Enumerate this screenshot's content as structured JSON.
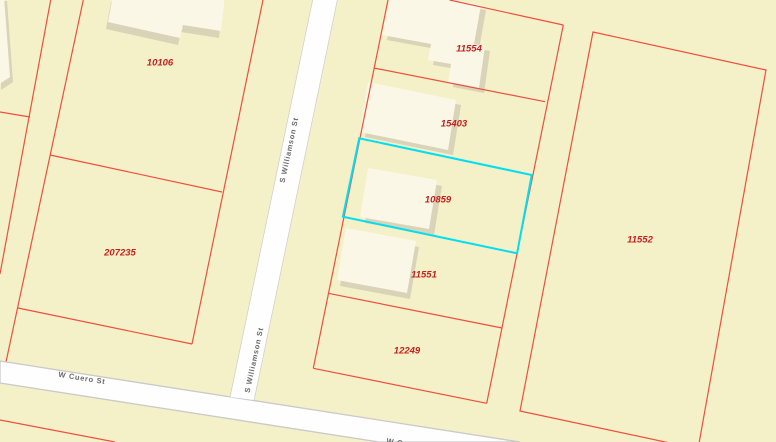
{
  "map": {
    "title": "parcel-map-view",
    "selected_parcel": "10859",
    "colors": {
      "background": "#f4f0c8",
      "parcel_line": "#ef4f3e",
      "parcel_label": "#c51f1c",
      "highlight": "#00dff2",
      "street_fill": "#fefefe",
      "street_casing": "#c9c9c9",
      "street_label": "#6a6a6a",
      "building_fill": "#faf7e7",
      "building_shadow": "#d9d3b8"
    },
    "parcels": [
      {
        "label": "10106",
        "label_x": 160,
        "label_y": 63,
        "selected": false
      },
      {
        "label": "207235",
        "label_x": 120,
        "label_y": 253,
        "selected": false
      },
      {
        "label": "11554",
        "label_x": 469,
        "label_y": 49,
        "selected": false
      },
      {
        "label": "15403",
        "label_x": 454,
        "label_y": 124,
        "selected": false
      },
      {
        "label": "10859",
        "label_x": 438,
        "label_y": 200,
        "selected": true
      },
      {
        "label": "11551",
        "label_x": 424,
        "label_y": 275,
        "selected": false
      },
      {
        "label": "12249",
        "label_x": 407,
        "label_y": 351,
        "selected": false
      },
      {
        "label": "11552",
        "label_x": 640,
        "label_y": 240,
        "selected": false
      }
    ],
    "streets": [
      {
        "name": "S Williamson St",
        "labels": [
          {
            "x": 289,
            "y": 150,
            "rot": -78
          },
          {
            "x": 254,
            "y": 360,
            "rot": -78
          }
        ]
      },
      {
        "name": "W Cuero St",
        "labels": [
          {
            "x": 82,
            "y": 378,
            "rot": 9
          },
          {
            "x": 410,
            "y": 444.5,
            "rot": 9
          }
        ]
      }
    ],
    "geometry": {
      "boundary_lines": [
        {
          "points": [
            [
              50.7,
              0
            ],
            [
              0,
              274
            ]
          ],
          "closed": false
        },
        {
          "points": [
            [
              83.3,
              0
            ],
            [
              6,
              362
            ]
          ],
          "closed": false
        },
        {
          "points": [
            [
              0,
              112
            ],
            [
              30,
              117
            ]
          ],
          "closed": false
        },
        {
          "points": [
            [
              263,
              0
            ],
            [
              192,
              344
            ]
          ],
          "closed": false
        },
        {
          "points": [
            [
              50,
              155
            ],
            [
              222,
              192
            ]
          ],
          "closed": false
        },
        {
          "points": [
            [
              18,
              308
            ],
            [
              192,
              344
            ]
          ],
          "closed": false
        },
        {
          "points": [
            [
              388,
              0
            ],
            [
              313.3,
              368.3
            ]
          ],
          "closed": false
        },
        {
          "points": [
            [
              449.6,
              0
            ],
            [
              563.3,
              25
            ]
          ],
          "closed": false
        },
        {
          "points": [
            [
              563.3,
              25
            ],
            [
              486.7,
              403.3
            ]
          ],
          "closed": false
        },
        {
          "points": [
            [
              373.8,
              68
            ],
            [
              545,
              101.7
            ]
          ],
          "closed": false
        },
        {
          "points": [
            [
              359.2,
              138.3
            ],
            [
              531.7,
              175
            ]
          ],
          "closed": false
        },
        {
          "points": [
            [
              342.9,
              216.7
            ],
            [
              517.1,
              253.3
            ]
          ],
          "closed": false
        },
        {
          "points": [
            [
              328.3,
              293.3
            ],
            [
              502,
              328
            ]
          ],
          "closed": false
        },
        {
          "points": [
            [
              313.3,
              368.3
            ],
            [
              486.7,
              403.3
            ]
          ],
          "closed": false
        },
        {
          "points": [
            [
              593,
              32
            ],
            [
              766,
              70
            ],
            [
              698,
              449
            ],
            [
              520,
              411
            ]
          ],
          "closed": true
        },
        {
          "points": [
            [
              0,
              420
            ],
            [
              115,
              442
            ]
          ],
          "closed": false
        }
      ],
      "highlight_polygon": [
        [
          359.2,
          138.3
        ],
        [
          531.7,
          175
        ],
        [
          517.1,
          253.3
        ],
        [
          342.9,
          216.7
        ]
      ],
      "buildings": [
        {
          "points": [
            [
              -2,
              -4
            ],
            [
              4,
              -4
            ],
            [
              10,
              77
            ],
            [
              -2,
              85
            ]
          ],
          "shadow": [
            3,
            5
          ]
        },
        {
          "points": [
            [
              113,
              -5
            ],
            [
              225,
              -5
            ],
            [
              221,
              31
            ],
            [
              183,
              25
            ],
            [
              180,
              38
            ],
            [
              108,
              22
            ]
          ],
          "shadow": [
            -2,
            7
          ]
        },
        {
          "points": [
            [
              392,
              -12
            ],
            [
              481,
              5
            ],
            [
              474,
              44
            ],
            [
              485,
              46
            ],
            [
              479,
              88
            ],
            [
              448,
              82
            ],
            [
              451,
              64
            ],
            [
              428,
              60
            ],
            [
              431,
              44
            ],
            [
              382,
              35
            ]
          ],
          "shadow": [
            5,
            5
          ]
        },
        {
          "points": [
            [
              368,
              82
            ],
            [
              456,
              100
            ],
            [
              448,
              150
            ],
            [
              360,
              132
            ]
          ],
          "shadow": [
            5,
            5
          ]
        },
        {
          "points": [
            [
              368,
              168
            ],
            [
              437,
              180
            ],
            [
              429,
              229
            ],
            [
              360,
              217
            ]
          ],
          "shadow": [
            5,
            6
          ]
        },
        {
          "points": [
            [
              346,
              228
            ],
            [
              416,
              241
            ],
            [
              407,
              293
            ],
            [
              337,
              280
            ]
          ],
          "shadow": [
            3,
            6
          ]
        }
      ],
      "street_shapes": {
        "williamson": [
          [
            313,
            0
          ],
          [
            337,
            0
          ],
          [
            253.8,
            400
          ],
          [
            230.4,
            397
          ]
        ],
        "cuero": [
          [
            0,
            361
          ],
          [
            520,
            442
          ],
          [
            379,
            442
          ],
          [
            0,
            383
          ]
        ]
      }
    }
  }
}
